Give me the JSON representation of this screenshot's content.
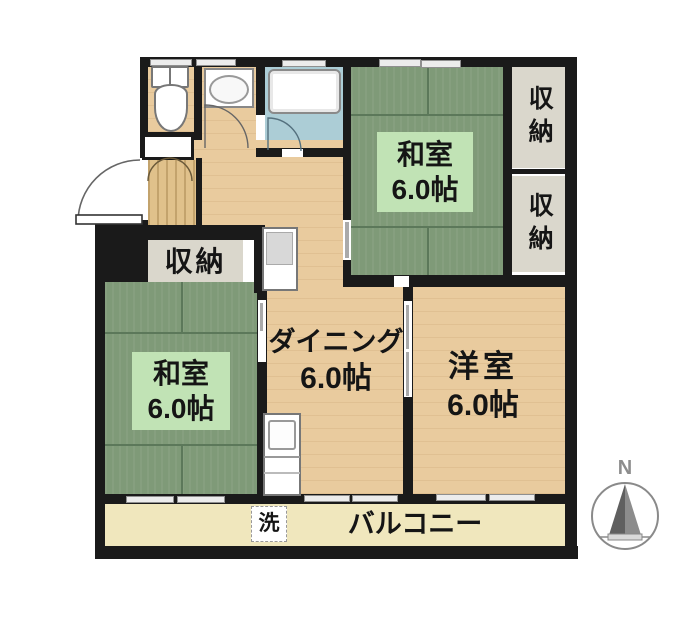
{
  "rooms": {
    "washitsu_top": {
      "name": "和室",
      "size": "6.0帖"
    },
    "washitsu_left": {
      "name": "和室",
      "size": "6.0帖"
    },
    "dining": {
      "name": "ダイニング",
      "size": "6.0帖"
    },
    "western_room": {
      "name": "洋室",
      "size": "6.0帖"
    },
    "balcony": {
      "name": "バルコニー"
    }
  },
  "storage": {
    "hall_label": "収納",
    "right_top_label": "収納",
    "right_bottom_label": "収納"
  },
  "laundry": {
    "label": "洗"
  },
  "compass": {
    "north_label": "N"
  },
  "colors": {
    "tatami_green": "#7f9a78",
    "tatami_label_bg": "#c1e3b5",
    "wood_floor": "#e9cb9e",
    "balcony_cream": "#f0e7bd",
    "closet_gray": "#dad7cc",
    "bath_blue": "#accdd6",
    "wall_black": "#1a1a1a"
  }
}
